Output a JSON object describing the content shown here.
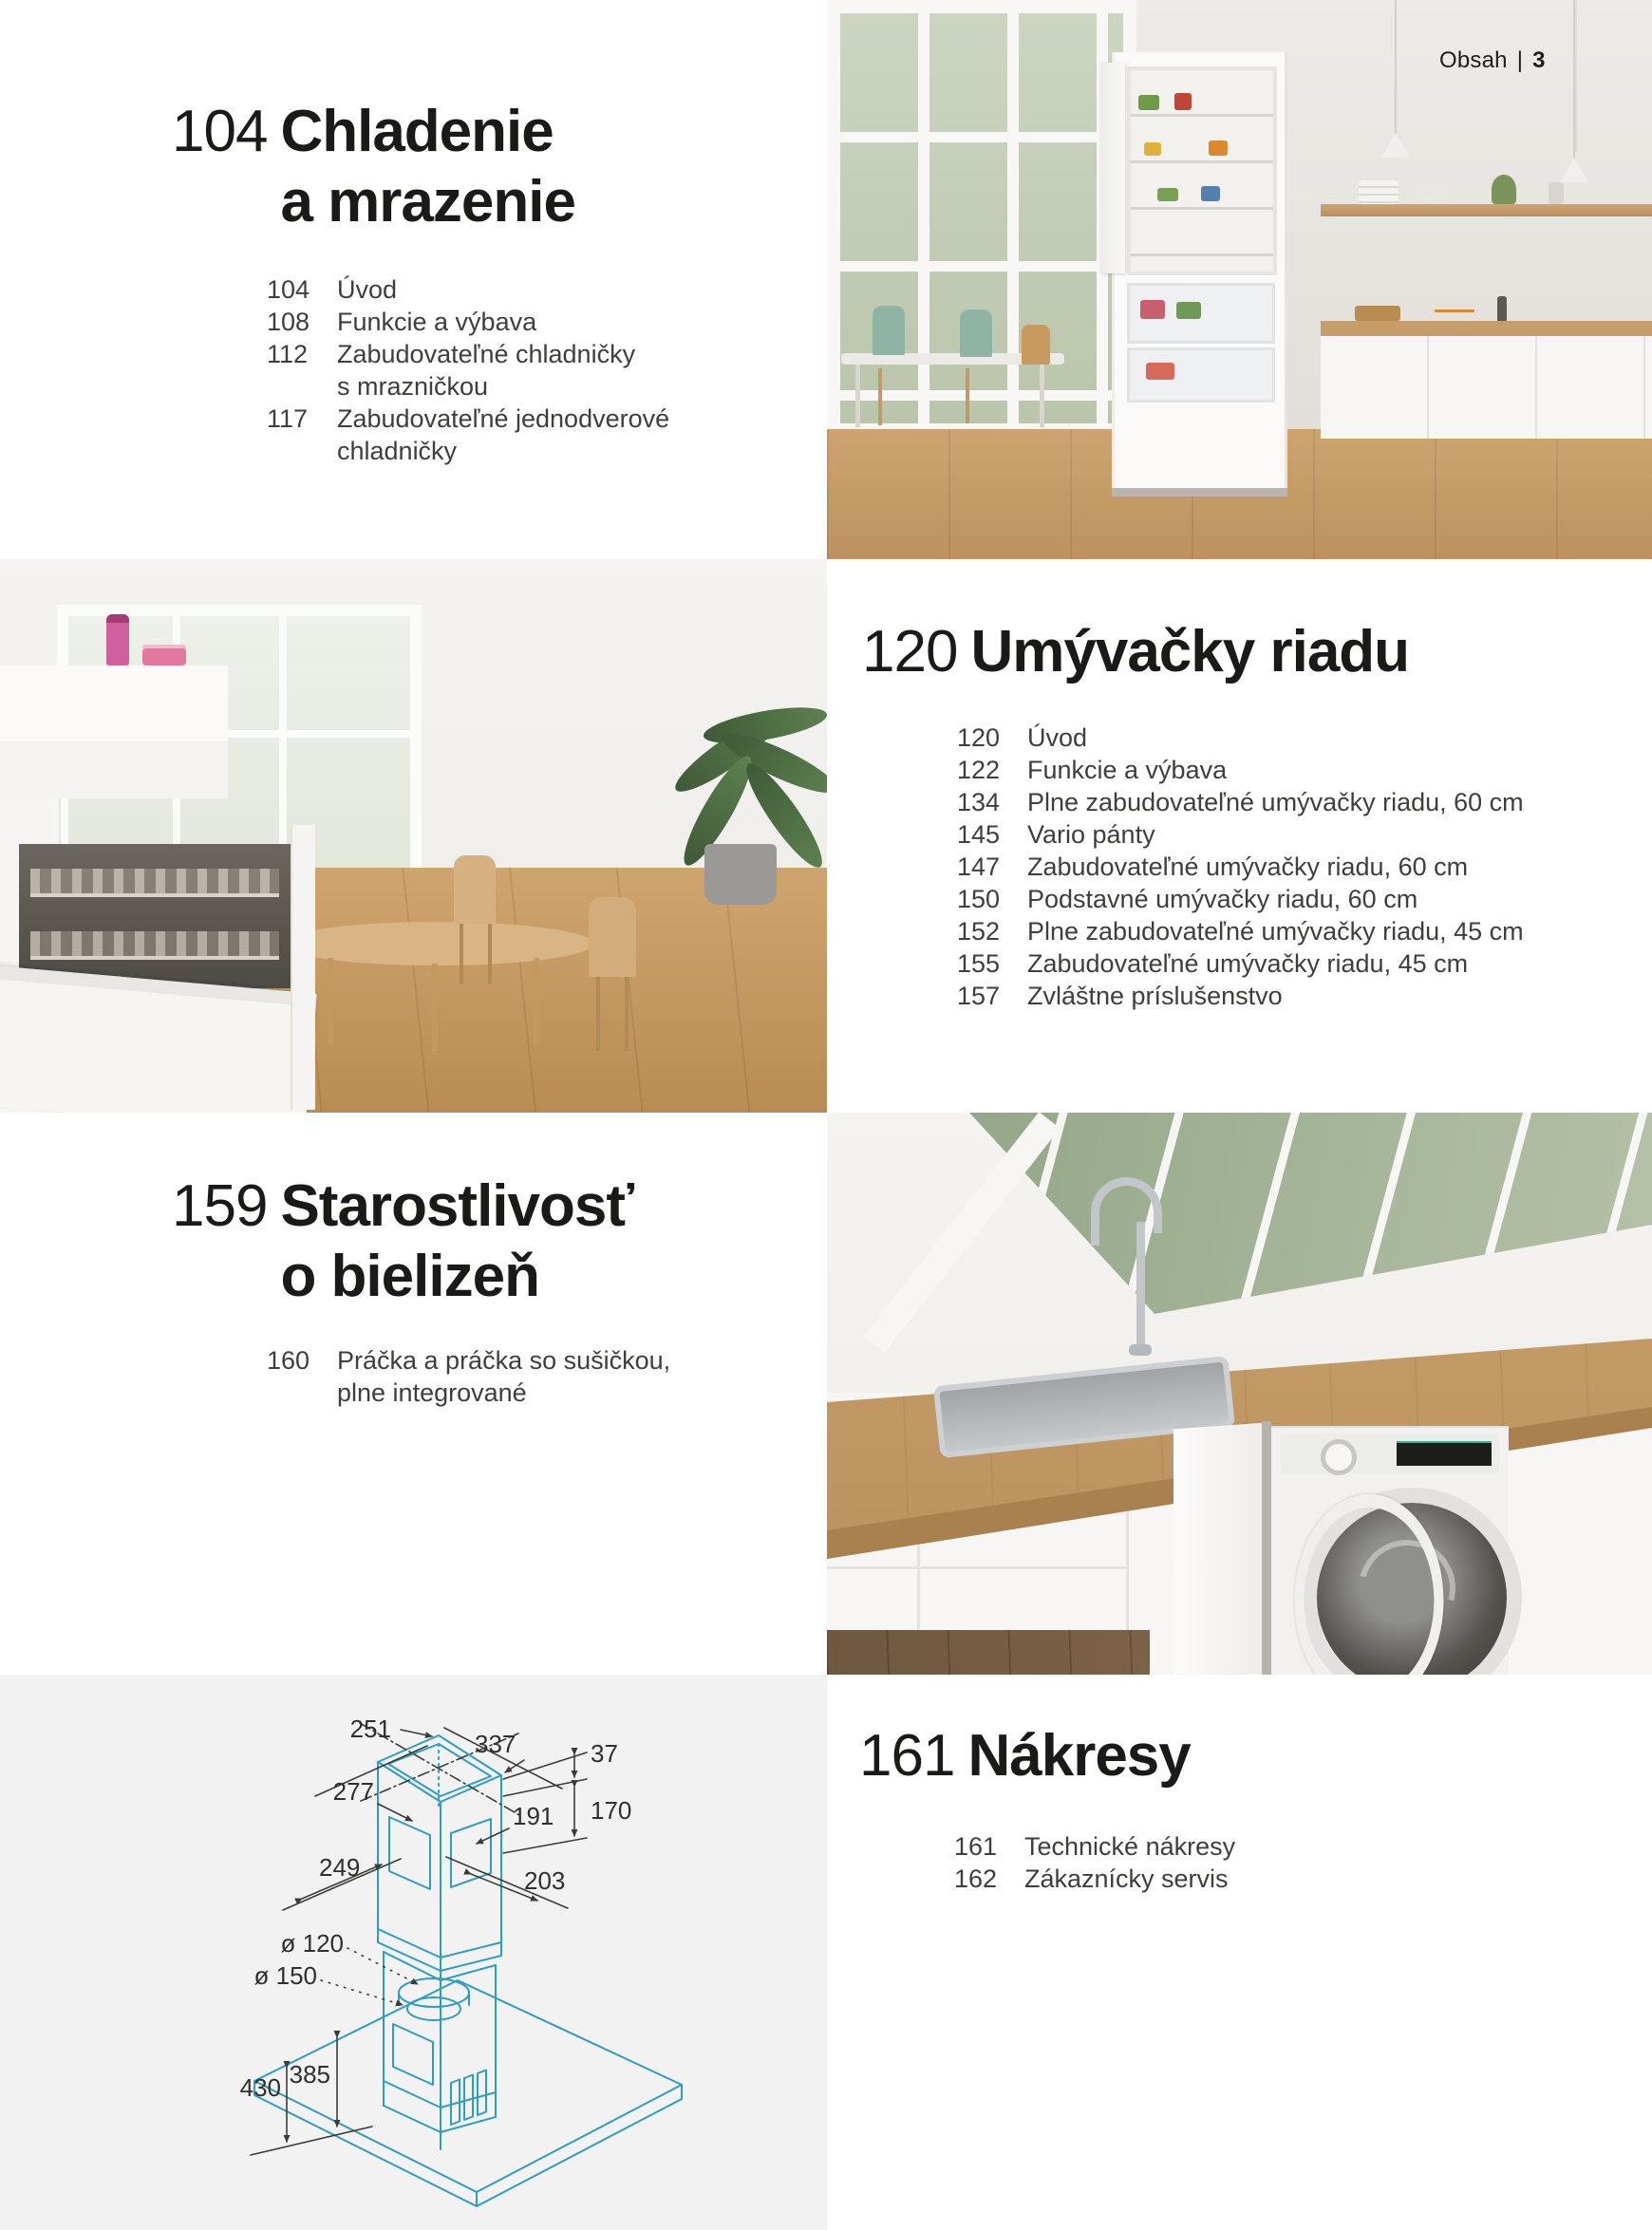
{
  "page": {
    "header": {
      "label": "Obsah",
      "separator": "|",
      "page_number": "3"
    }
  },
  "sections": [
    {
      "number": "104",
      "title": "Chladenie\na mrazenie",
      "items": [
        {
          "page": "104",
          "label": "Úvod"
        },
        {
          "page": "108",
          "label": "Funkcie a výbava"
        },
        {
          "page": "112",
          "label": "Zabudovateľné chladničky\ns mrazničkou"
        },
        {
          "page": "117",
          "label": "Zabudovateľné jednodverové\nchladničky"
        }
      ]
    },
    {
      "number": "120",
      "title": "Umývačky riadu",
      "items": [
        {
          "page": "120",
          "label": "Úvod"
        },
        {
          "page": "122",
          "label": "Funkcie a výbava"
        },
        {
          "page": "134",
          "label": "Plne zabudovateľné umývačky riadu, 60 cm"
        },
        {
          "page": "145",
          "label": "Vario pánty"
        },
        {
          "page": "147",
          "label": "Zabudovateľné umývačky riadu, 60 cm"
        },
        {
          "page": "150",
          "label": "Podstavné umývačky riadu, 60 cm"
        },
        {
          "page": "152",
          "label": "Plne zabudovateľné umývačky riadu, 45 cm"
        },
        {
          "page": "155",
          "label": "Zabudovateľné umývačky riadu, 45 cm"
        },
        {
          "page": "157",
          "label": "Zvláštne príslušenstvo"
        }
      ]
    },
    {
      "number": "159",
      "title": "Starostlivosť\no bielizeň",
      "items": [
        {
          "page": "160",
          "label": "Práčka a práčka so sušičkou,\nplne integrované"
        }
      ]
    },
    {
      "number": "161",
      "title": "Nákresy",
      "items": [
        {
          "page": "161",
          "label": "Technické nákresy"
        },
        {
          "page": "162",
          "label": "Zákaznícky servis"
        }
      ]
    }
  ],
  "drawing": {
    "line_color": "#2e9dc0",
    "dimensions": {
      "d251": "251",
      "d337": "337",
      "d37": "37",
      "d170": "170",
      "d277": "277",
      "d191": "191",
      "d249": "249",
      "d203": "203",
      "dia120": "ø 120",
      "dia150": "ø 150",
      "d385": "385",
      "d430": "430"
    }
  },
  "colors": {
    "drawing_blue": "#2e9dc0",
    "panel_gray": "#f2f2f3",
    "heading_text": "#1a1a18",
    "body_text": "#3f3e3d",
    "wood": "#c79e6a"
  }
}
